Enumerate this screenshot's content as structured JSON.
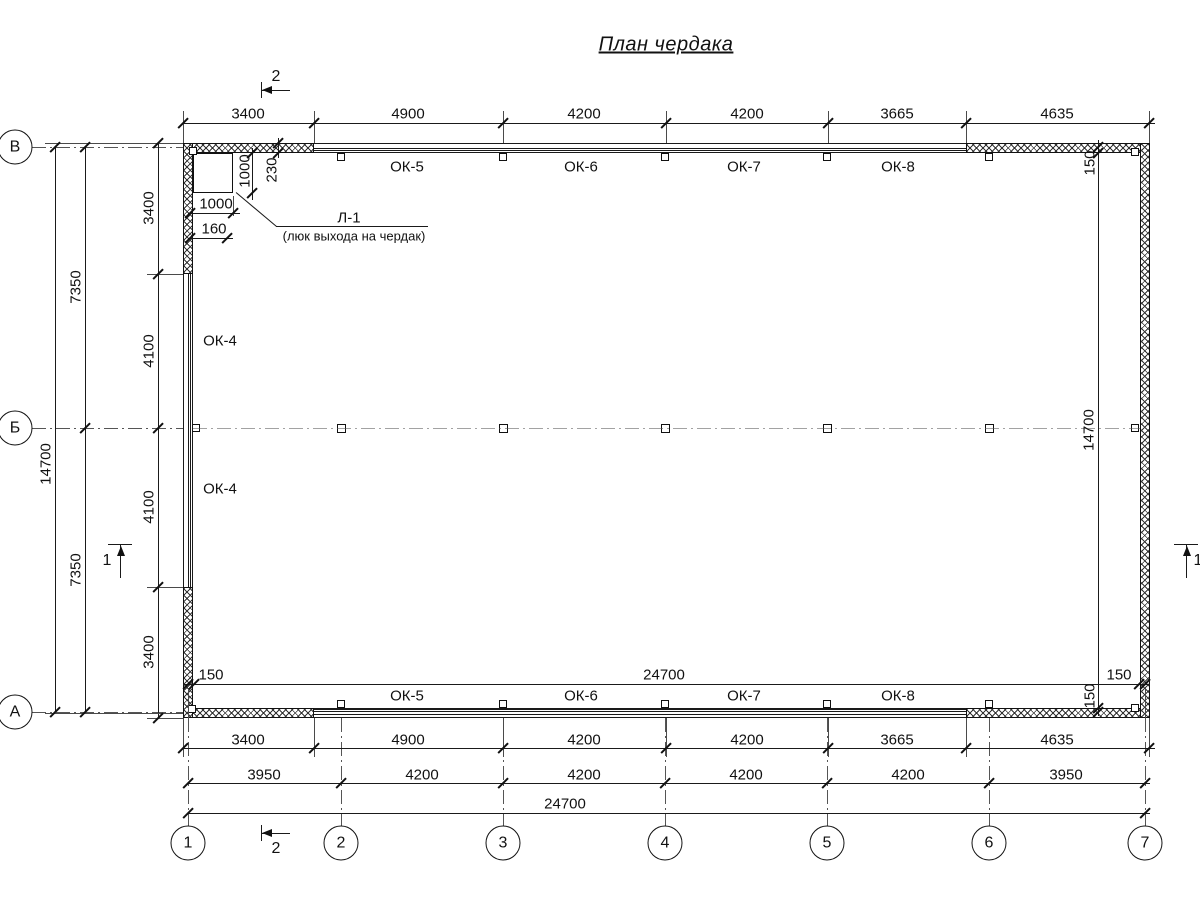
{
  "title": "План чердака",
  "axes": {
    "rows": [
      "В",
      "Б",
      "А"
    ],
    "cols": [
      "1",
      "2",
      "3",
      "4",
      "5",
      "6",
      "7"
    ]
  },
  "sections": {
    "cut_vertical": "2",
    "cut_horizontal": "1"
  },
  "dimensions": {
    "top": [
      "3400",
      "4900",
      "4200",
      "4200",
      "3665",
      "4635"
    ],
    "bottom_piers": [
      "3400",
      "4900",
      "4200",
      "4200",
      "3665",
      "4635"
    ],
    "bottom_axes": [
      "3950",
      "4200",
      "4200",
      "4200",
      "4200",
      "3950"
    ],
    "bottom_total": "24700",
    "left_inner": [
      "3400",
      "4100",
      "4100",
      "3400"
    ],
    "left_mid": [
      "7350",
      "7350"
    ],
    "left_total": "14700",
    "inner_bottom": [
      "150",
      "24700",
      "150"
    ],
    "inner_right": [
      "150",
      "14700",
      "150"
    ],
    "hatch_width": "1000",
    "hatch_height": "1000",
    "hatch_offset": "230",
    "hatch_edge": "160"
  },
  "windows": {
    "top": [
      "ОК-5",
      "ОК-6",
      "ОК-7",
      "ОК-8"
    ],
    "bottom": [
      "ОК-5",
      "ОК-6",
      "ОК-7",
      "ОК-8"
    ],
    "left": [
      "ОК-4",
      "ОК-4"
    ]
  },
  "hatch_note": {
    "code": "Л-1",
    "description": "(люк выхода на чердак)"
  },
  "colors": {
    "line": "#1a1a1a",
    "background": "#ffffff",
    "axis_line": "#555555"
  }
}
